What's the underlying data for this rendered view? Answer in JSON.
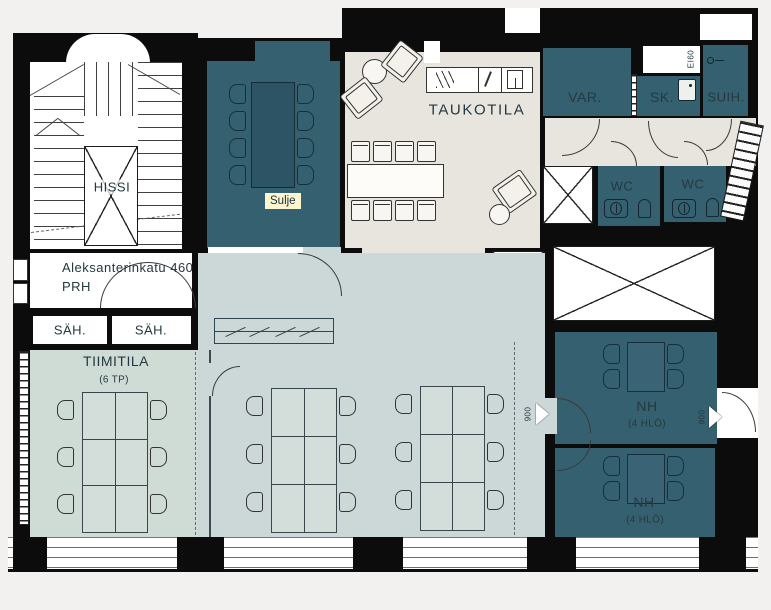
{
  "plan_title": "office-floor-plan",
  "labels": {
    "hissi": "HISSI",
    "address_line": "Aleksanterinkatu 460",
    "address_line2": "PRH",
    "sah_left": "SÄH.",
    "sah_right": "SÄH.",
    "tiimitila": "TIIMITILA",
    "tiimitila_cap": "(6 TP)",
    "taukotila": "TAUKOTILA",
    "var": "VAR.",
    "sk": "SK.",
    "suih": "SUIH.",
    "wc_left": "WC",
    "wc_right": "WC",
    "nh_top": "NH",
    "nh_top_cap": "(4 HLÖ)",
    "nh_bottom": "NH",
    "nh_bottom_cap": "(4 HLÖ)",
    "fire_rating": "EI60",
    "door_width_mid": "900",
    "door_width_right": "900"
  },
  "button": {
    "label": "Sulje"
  },
  "colors": {
    "wall": "#0c0c0c",
    "room_teal": "#35606f",
    "open_space": "#ccd8d8",
    "tiimitila_floor": "#cfdcd6",
    "taukotila_floor": "#e8e5df",
    "button_bg": "#fcf5d0",
    "label_text": "#24393f"
  }
}
